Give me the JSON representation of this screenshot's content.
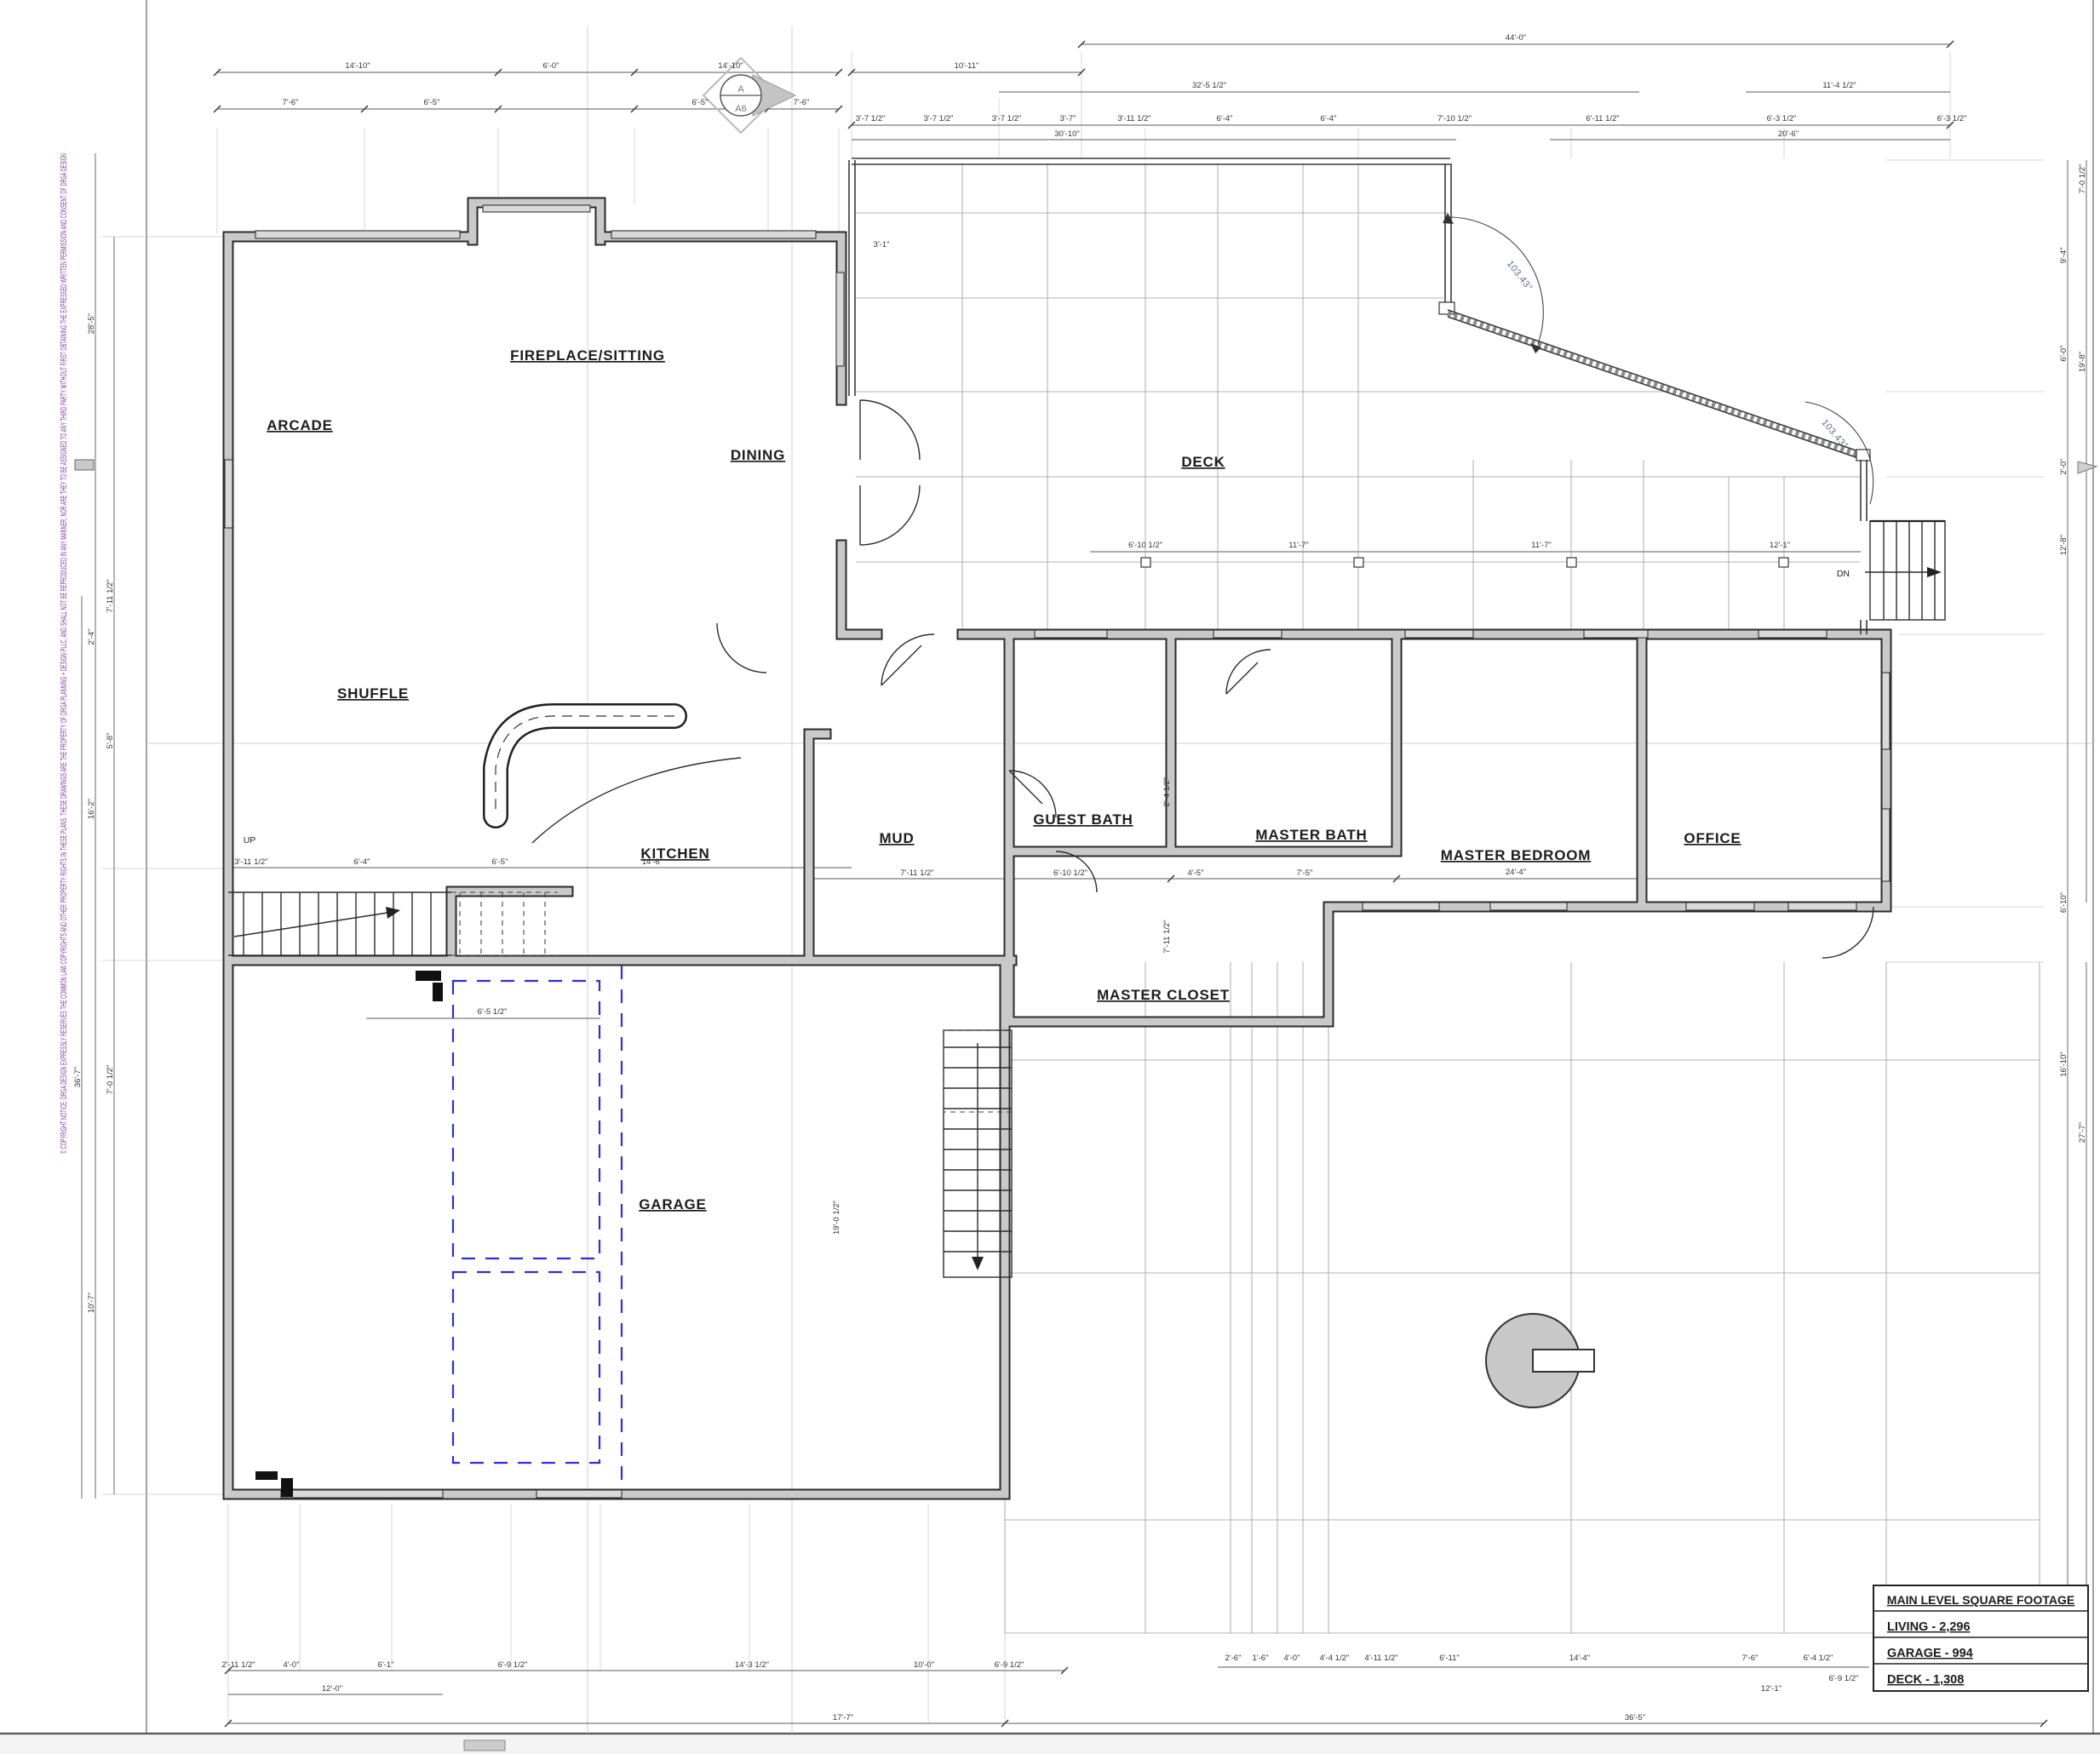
{
  "sheet": {
    "copyright_notice": "© COPYRIGHT NOTICE: DRGA DESIGN EXPRESSLY RESERVES THE COMMON LAW COPYRIGHTS AND OTHER PROPERTY RIGHTS IN THESE PLANS. THESE DRAWINGS ARE THE PROPERTY OF DRGA PLANNING + DESIGN PLLC, AND SHALL NOT BE REPRODUCED IN ANY MANNER, NOR ARE THEY TO BE ASSIGNED TO ANY THIRD PARTY WITHOUT FIRST OBTAINING THE EXPRESSED WRITTEN PERMISSION AND CONSENT OF DRGA DESIGN",
    "accent_purple": "#8a35a5",
    "wall_gray": "#c9c9c9",
    "dashed_blue": "#2f2fd8",
    "angle_blue": "#5d6d86"
  },
  "rooms": {
    "arcade": "ARCADE",
    "fireplace_sitting": "FIREPLACE/SITTING",
    "dining": "DINING",
    "deck": "DECK",
    "shuffle": "SHUFFLE",
    "kitchen": "KITCHEN",
    "mud": "MUD",
    "guest_bath": "GUEST BATH",
    "master_bath": "MASTER BATH",
    "master_closet": "MASTER CLOSET",
    "master_bedroom": "MASTER BEDROOM",
    "office": "OFFICE",
    "garage": "GARAGE"
  },
  "annotations": {
    "stair_up": "UP",
    "stair_dn": "DN",
    "angle_top": "103.43°",
    "angle_right": "103.43°",
    "section_marker_top": "A",
    "section_marker_bottom": "A6"
  },
  "footage_table": {
    "title": "MAIN LEVEL SQUARE FOOTAGE",
    "rows": [
      "LIVING - 2,296",
      "GARAGE - 994",
      "DECK - 1,308"
    ]
  },
  "dims": {
    "t1": "14'-10\"",
    "t2": "6'-0\"",
    "t3": "14'-10\"",
    "t4": "10'-11\"",
    "t5": "44'-0\"",
    "t6": "7'-6\"",
    "t7": "6'-5\"",
    "t8": "6'-5\"",
    "t9": "7'-6\"",
    "t10": "32'-5 1/2\"",
    "t11": "11'-4 1/2\"",
    "t12": "3'-7 1/2\"",
    "t13": "3'-7 1/2\"",
    "t14": "3'-7 1/2\"",
    "t15": "3'-7\"",
    "t16": "3'-11 1/2\"",
    "t17": "6'-4\"",
    "t18": "6'-4\"",
    "t19": "7'-10 1/2\"",
    "t20": "6'-11 1/2\"",
    "t21": "6'-3 1/2\"",
    "t22": "6'-3 1/2\"",
    "t23": "30'-10\"",
    "t24": "20'-6\"",
    "d1": "3'-1\"",
    "d2": "6'-10 1/2\"",
    "d3": "11'-7\"",
    "d4": "11'-7\"",
    "d5": "12'-1\"",
    "m1": "7'-11 1/2\"",
    "m2": "6'-10 1/2\"",
    "m3": "4'-5\"",
    "m4": "7'-5\"",
    "m5": "24'-4\"",
    "m6": "6'-4\"",
    "m7": "6'-5\"",
    "m8": "14'-6\"",
    "m9": "3'-11 1/2\"",
    "m10": "6'-5 1/2\"",
    "v1": "2'-4 1/2\"",
    "v2": "7'-11 1/2\"",
    "v3": "19'-0 1/2\"",
    "l1": "28'-5\"",
    "l2": "7'-11 1/2\"",
    "l3": "2'-4\"",
    "l4": "5'-8\"",
    "l5": "16'-2\"",
    "l6": "7'-0 1/2\"",
    "l7": "10'-7\"",
    "l8": "36'-7\"",
    "r1": "7'-0 1/2\"",
    "r2": "9'-4\"",
    "r3": "6'-0\"",
    "r4": "19'-8\"",
    "r5": "2'-0\"",
    "r6": "12'-8\"",
    "r7": "6'-10\"",
    "r8": "16'-10\"",
    "r9": "27'-7\"",
    "r10": "3'-4\"",
    "b1": "2'-11 1/2\"",
    "b2": "4'-0\"",
    "b3": "6'-1\"",
    "b4": "6'-9 1/2\"",
    "b5": "14'-3 1/2\"",
    "b6": "6'-9 1/2\"",
    "b7": "12'-0\"",
    "b8": "10'-0\"",
    "b9": "17'-7\"",
    "b10": "36'-5\"",
    "c1": "2'-6\"",
    "c2": "1'-6\"",
    "c3": "4'-0\"",
    "c4": "4'-4 1/2\"",
    "c5": "4'-11 1/2\"",
    "c6": "6'-11\"",
    "c7": "14'-4\"",
    "c8": "7'-6\"",
    "c9": "6'-4 1/2\"",
    "c10": "6'-9 1/2\"",
    "c11": "12'-1\""
  }
}
